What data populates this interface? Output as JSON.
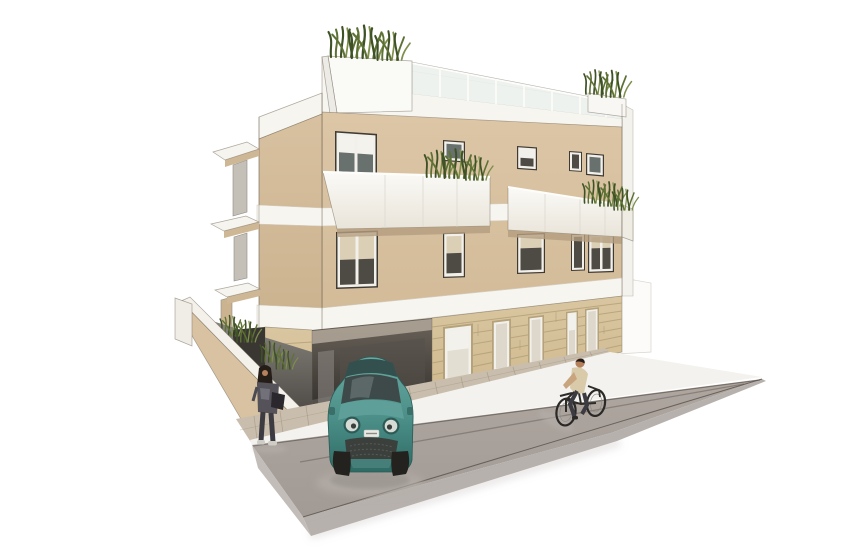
{
  "meta": {
    "title": "Architectural rendering - three-storey apartment building with street scene",
    "type": "3d exterior visualization",
    "description": "White-background render of a modern three-storey beige apartment building with white floor bands, glass-fronted balconies, rooftop terrace planters with ornamental grasses, a stone-clad ground floor with tall windows, a dark carport passage with a teal compact city car, a side ramp with parapet wall and grasses, a paved sidewalk, a grey road wedge, a cyclist and a standing pedestrian."
  },
  "scene": {
    "building": {
      "storeys": 3,
      "roof": {
        "feature": "terrace with glass railing",
        "planters": 2,
        "plants": "ornamental grasses"
      },
      "balconies_front": 2,
      "upper_windows": 10,
      "ground_floor": {
        "cladding": "stone ashlar courses",
        "tall_windows": 5,
        "carport_opening": 1
      },
      "side_structures": [
        "stair tower",
        "west cantilever balconies",
        "basement ramp with parapet"
      ]
    },
    "street": {
      "elements": [
        "brick paver sidewalk",
        "white curb",
        "grey asphalt slab road"
      ],
      "vehicle": {
        "type": "compact city car, front view",
        "color_name": "teal"
      },
      "people": [
        {
          "role": "pedestrian",
          "pose": "standing near building corner",
          "clothing": "dark grey outfit"
        },
        {
          "role": "cyclist",
          "pose": "riding on road",
          "clothing": "beige shirt, dark trousers"
        }
      ]
    }
  },
  "colors": {
    "background": "#ffffff",
    "facade": "#dcc6a6",
    "facade_b": "#d2ba97",
    "tower": "#d8c1a0",
    "tower_b": "#ccb390",
    "band": "#f7f5f0",
    "band_edge": "#cfc9bd",
    "edge": "#6f6454",
    "white_struct": "#f4f2ec",
    "glass_rail": "#edf1ee",
    "window_dark": "#4e4a44",
    "window_blue": "#68716e",
    "frame_white": "#f2f0ea",
    "shade": "#dbcfb6",
    "frame_tan": "#b5a27b",
    "stone": "#d9c6a0",
    "stone_b": "#cfb98f",
    "stone_line": "#b29f77",
    "carport_dark": "#2b2824",
    "ramp_face": "#d8c2a2",
    "recess": "#c4c0b8",
    "road_top": "#a9a19c",
    "road_face": "#b7b1ad",
    "road_left": "#c3bdb9",
    "road_line": "#635c55",
    "curb": "#f4f2ee",
    "paver": "#c9bead",
    "paver_line": "#a59885",
    "plant_dark": "#3f5226",
    "plant_mid": "#5e7135",
    "plant_light": "#7e8f4c",
    "car_teal": "#4a8e87",
    "car_teal_light": "#69aaa2",
    "car_teal_dark": "#2f6b65",
    "car_glass": "#3e4a4a",
    "tire": "#24221f",
    "metal": "#d6dbd6",
    "hair": "#241d18",
    "skin": "#b5805c",
    "shirt": "#d9cbaa",
    "pants": "#3c3b42",
    "woman_top": "#55525a",
    "woman_hi": "#908e97",
    "bag": "#2a282c",
    "shadow": "#b7b1ab"
  }
}
